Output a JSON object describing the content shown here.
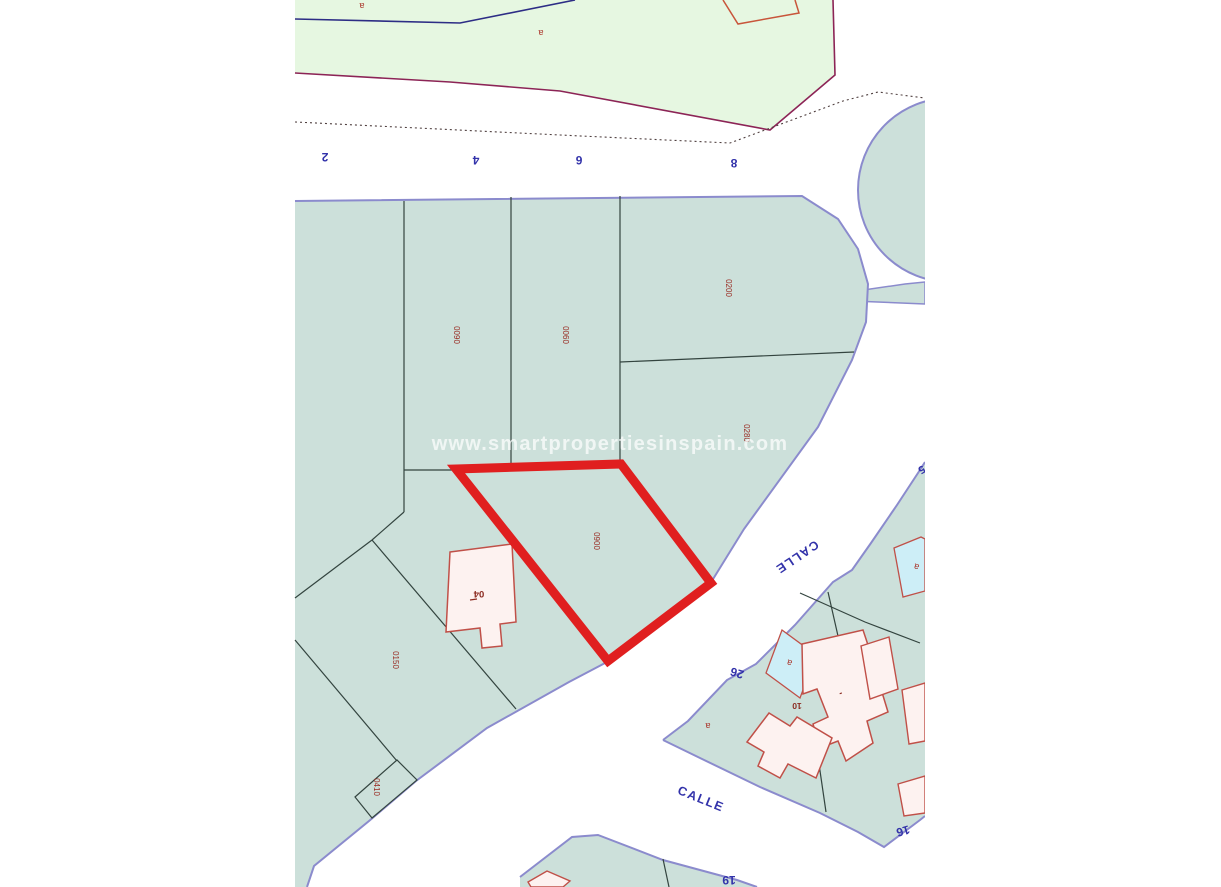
{
  "map": {
    "watermark": "www.smartpropertiesinspain.com",
    "street_labels": [
      {
        "text": "CALLE"
      },
      {
        "text": "CALLE"
      }
    ],
    "street_numbers": [
      {
        "text": "2"
      },
      {
        "text": "4"
      },
      {
        "text": "6"
      },
      {
        "text": "8"
      },
      {
        "text": "26"
      },
      {
        "text": "16"
      },
      {
        "text": "19"
      },
      {
        "text": "5"
      }
    ],
    "parcel_labels": [
      {
        "text": "0090"
      },
      {
        "text": "0060"
      },
      {
        "text": "0200"
      },
      {
        "text": "0280"
      },
      {
        "text": "0900"
      },
      {
        "text": "0150"
      },
      {
        "text": "0410"
      }
    ],
    "building_labels": [
      {
        "text": "04"
      },
      {
        "text": "10"
      },
      {
        "text": "-"
      }
    ],
    "area_letters": [
      {
        "text": "a"
      },
      {
        "text": "a"
      },
      {
        "text": "a"
      },
      {
        "text": "a"
      },
      {
        "text": "a"
      }
    ],
    "colors": {
      "parcel_fill": "#cce0da",
      "green_area_fill": "#e6f7e1",
      "street_border": "#8b8bcd",
      "plot_highlight": "#e01f1f",
      "building_fill": "#fdf2f0",
      "building_border": "#c05048",
      "pool_fill": "#cdeef7",
      "parcel_line": "#33443f",
      "label_blue": "#3232aa",
      "label_red": "#992b22",
      "green_border_magenta": "#8c2456",
      "green_border_blue": "#2d2d85"
    }
  }
}
